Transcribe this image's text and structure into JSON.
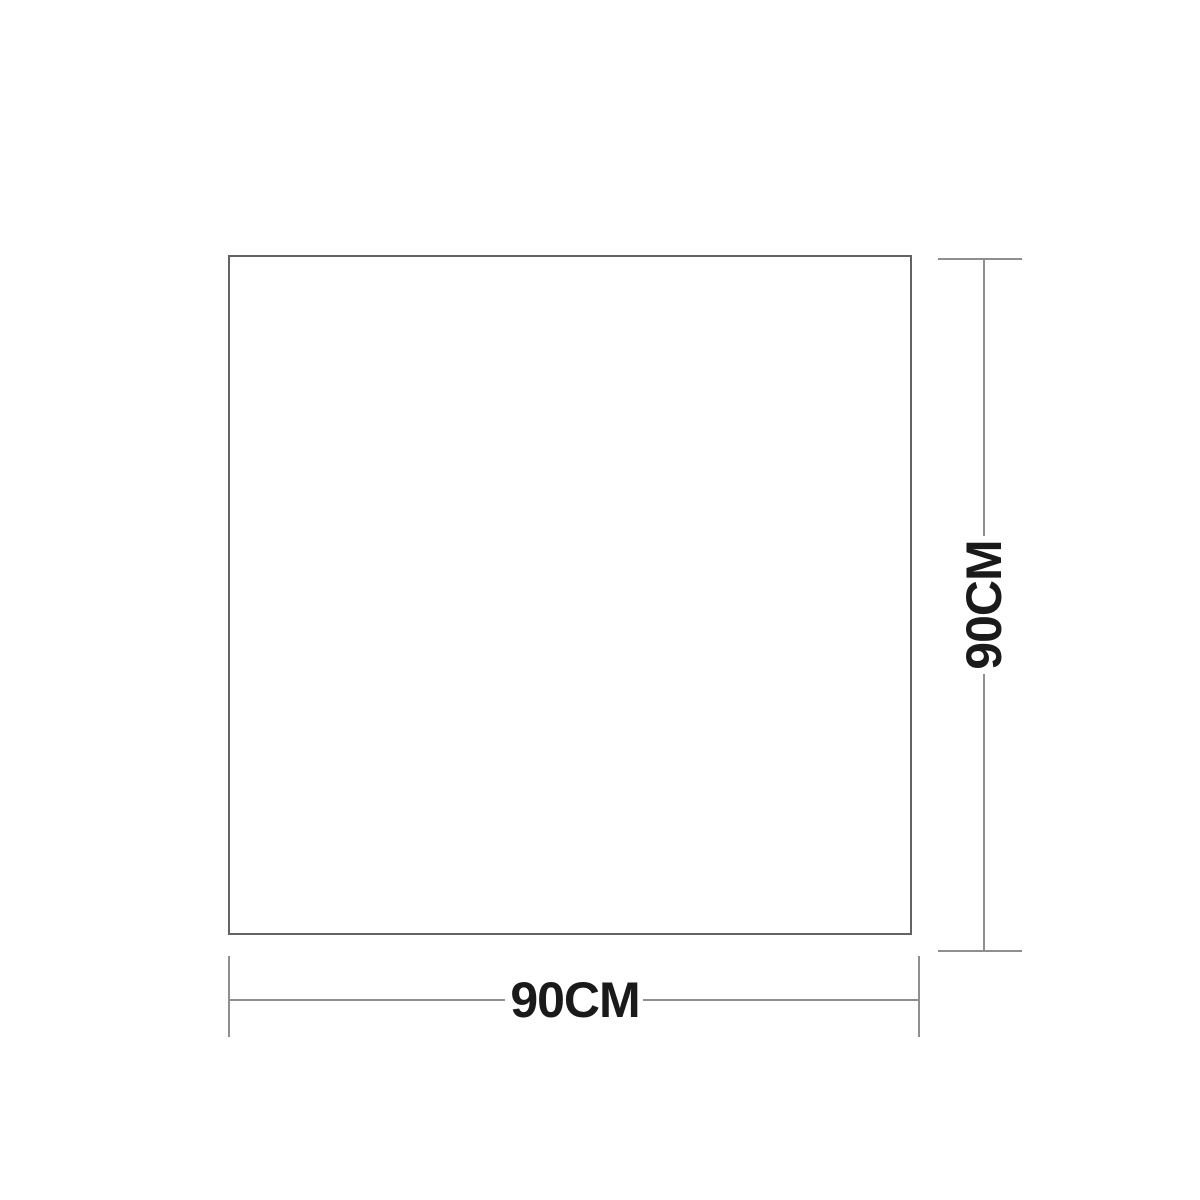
{
  "diagram": {
    "type": "product-dimension-diagram",
    "shape": "square",
    "width_label": "90CM",
    "height_label": "90CM",
    "colors": {
      "background": "#ffffff",
      "shape_outline": "#636363",
      "dimension_line": "#8f8f8f",
      "label_text": "#1a1a1a"
    }
  }
}
